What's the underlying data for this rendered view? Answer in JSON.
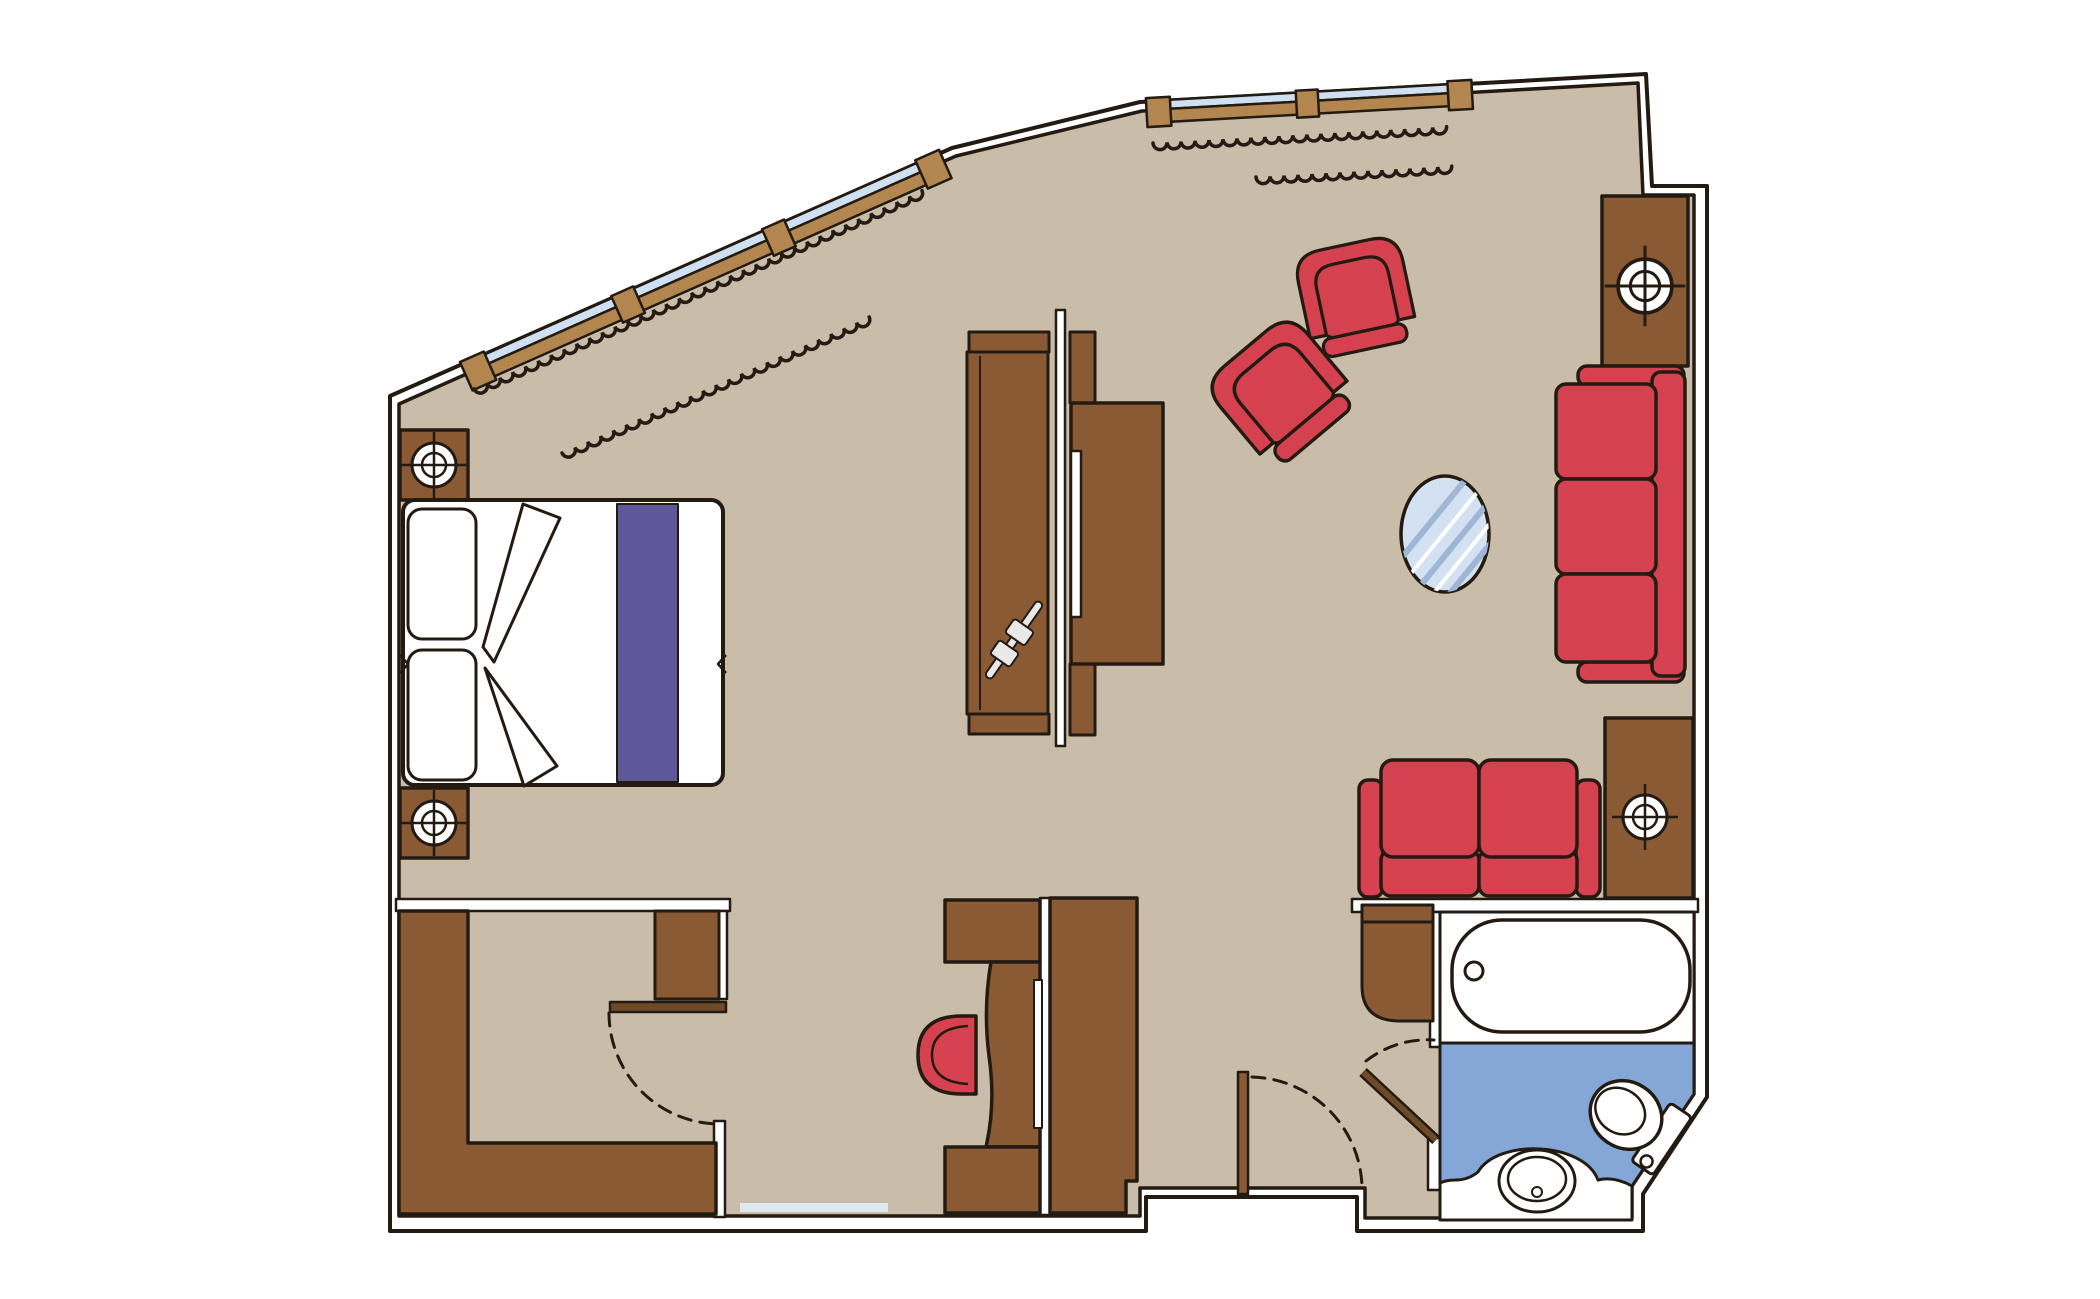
{
  "document": {
    "kind": "architectural-floor-plan",
    "subject": "hotel-suite-top-view",
    "background": "#ffffff"
  },
  "colors": {
    "wall_line": "#231b12",
    "wall_fill": "#ffffff",
    "floor_tan": "#c9bca8",
    "wood_brown": "#8a5a35",
    "window_frame_tan": "#b3864f",
    "door_brown": "#6f4a28",
    "upholstery_red": "#d64150",
    "bed_runner_purple": "#5e5798",
    "window_glass_blue": "#cfe0f2",
    "bathroom_tile_blue": "#84a7d8",
    "glass_table_blue": "#d3e1f3",
    "hatch_blue": "#9fb6d4",
    "threshold_blue": "#dfe9f0",
    "metal_grey": "#e9e9e9"
  },
  "rooms": [
    {
      "name": "bedroom"
    },
    {
      "name": "living-area"
    },
    {
      "name": "dressing-room"
    },
    {
      "name": "entry-hall"
    },
    {
      "name": "bathroom"
    }
  ],
  "furniture": [
    "double-bed",
    "pillow",
    "bed-runner",
    "nightstand",
    "reading-light-symbol",
    "wardrobe",
    "clothes-hanger-symbol",
    "tv-partition",
    "tv-console",
    "tv-screen",
    "armchair",
    "glass-side-table",
    "three-seat-sofa",
    "loveseat",
    "wall-cabinet",
    "corner-cabinet",
    "dressing-table",
    "dressing-stool",
    "entry-wardrobe",
    "l-shaped-closet",
    "dressing-cabinet"
  ],
  "fixtures": [
    "bathtub",
    "toilet",
    "washbasin",
    "tiled-floor",
    "threshold-mat"
  ],
  "openings": {
    "windows": 2,
    "doors": 3,
    "door_swing_symbols": 3,
    "curtain_rows": 4
  }
}
